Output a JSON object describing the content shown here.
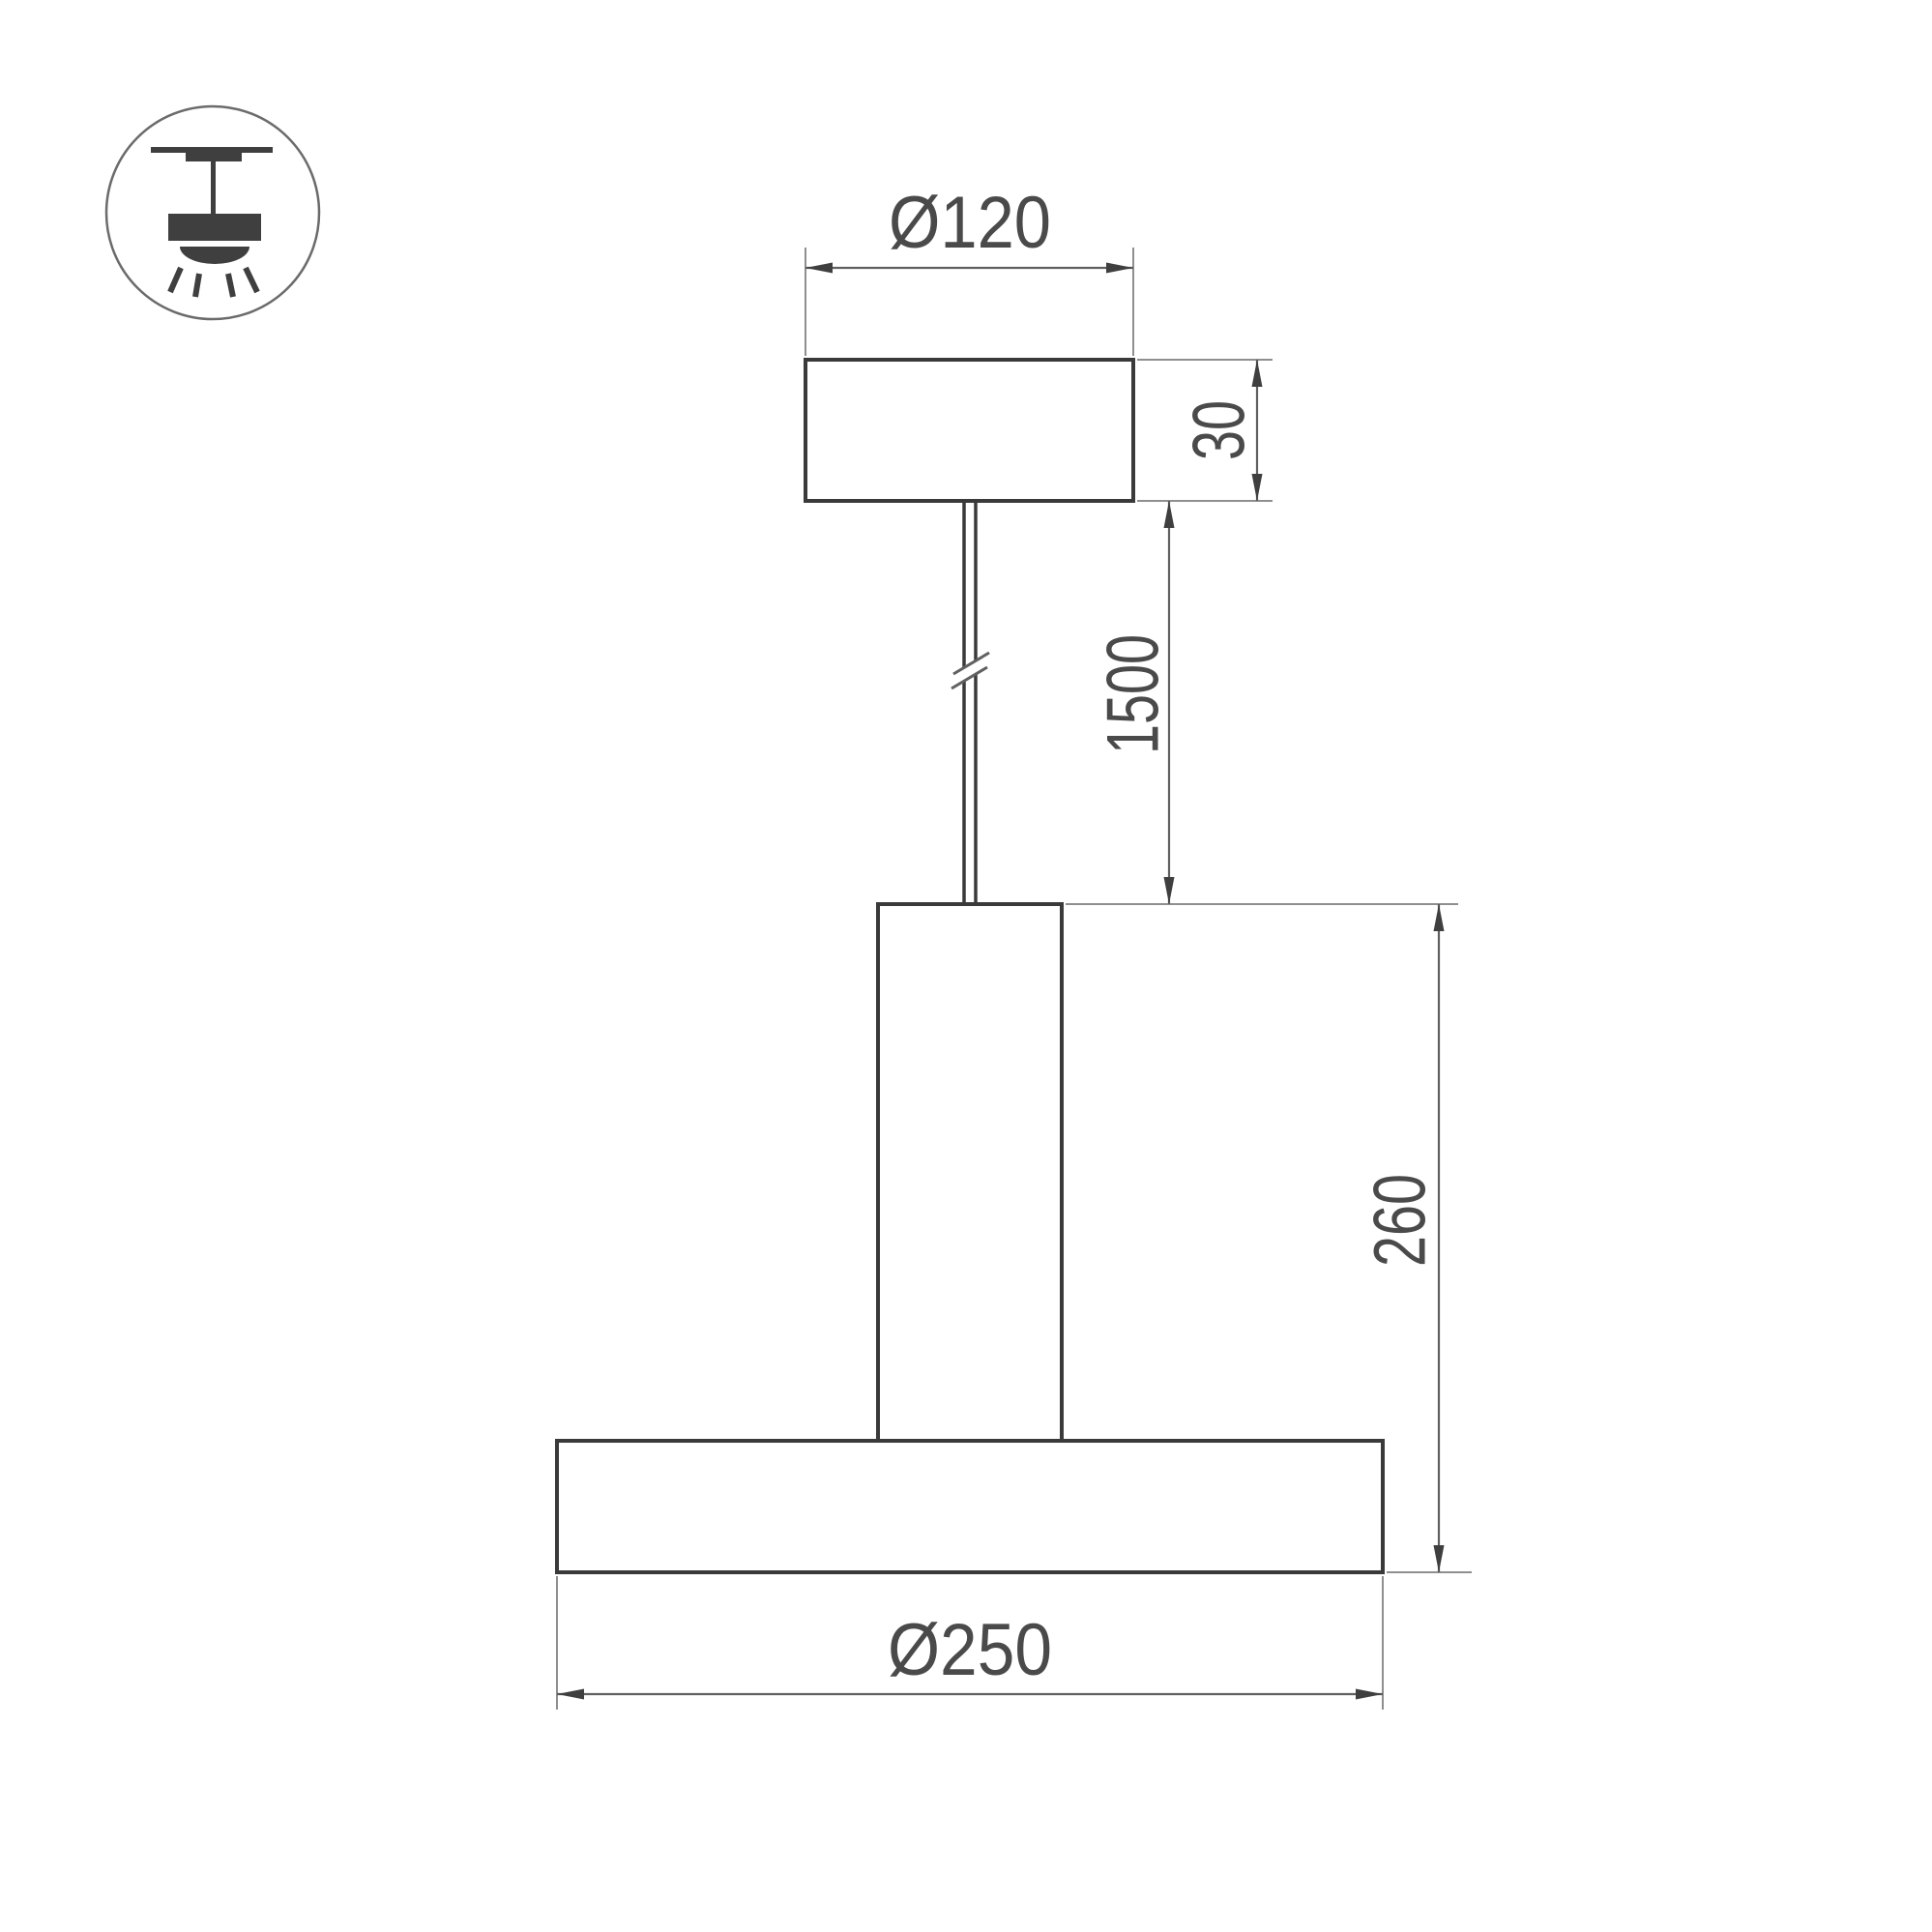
{
  "icon": {
    "name": "suspended-ceiling-luminaire-icon"
  },
  "dimensions": {
    "canopy_diameter": "Ø120",
    "canopy_height": "30",
    "suspension_length": "1500",
    "fixture_height": "260",
    "shade_diameter": "Ø250"
  },
  "colors": {
    "background": "#ffffff",
    "object_line": "#3a3a3a",
    "dimension_line": "#606060",
    "extension_line": "#8f8f8f",
    "arrow": "#3f3f3f",
    "label": "#4a4a4a",
    "icon_fill": "#3f3f3f",
    "icon_circle": "#6b6b6b"
  }
}
